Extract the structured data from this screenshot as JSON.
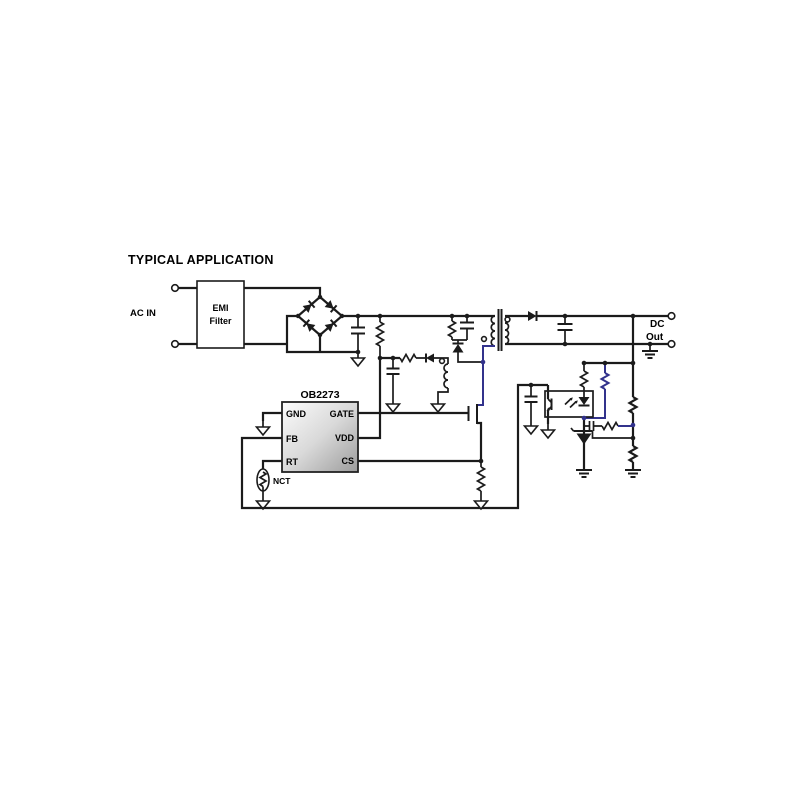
{
  "figure": {
    "title": "TYPICAL APPLICATION"
  },
  "colors": {
    "background": "#ffffff",
    "wire": "#1b1b1b",
    "accent_wire": "#32328c",
    "text": "#000000",
    "ic_fill_light": "#fcfcfc",
    "ic_fill_mid": "#d9d9d9",
    "ic_fill_dark": "#9c9c9c",
    "ic_border": "#222222"
  },
  "labels": {
    "ac_in": "AC IN",
    "emi_line1": "EMI",
    "emi_line2": "Filter",
    "dc_line1": "DC",
    "dc_line2": "Out",
    "nct": "NCT"
  },
  "ic": {
    "name": "OB2273",
    "left_pins": [
      "GND",
      "FB",
      "RT"
    ],
    "right_pins": [
      "GATE",
      "VDD",
      "CS"
    ]
  }
}
